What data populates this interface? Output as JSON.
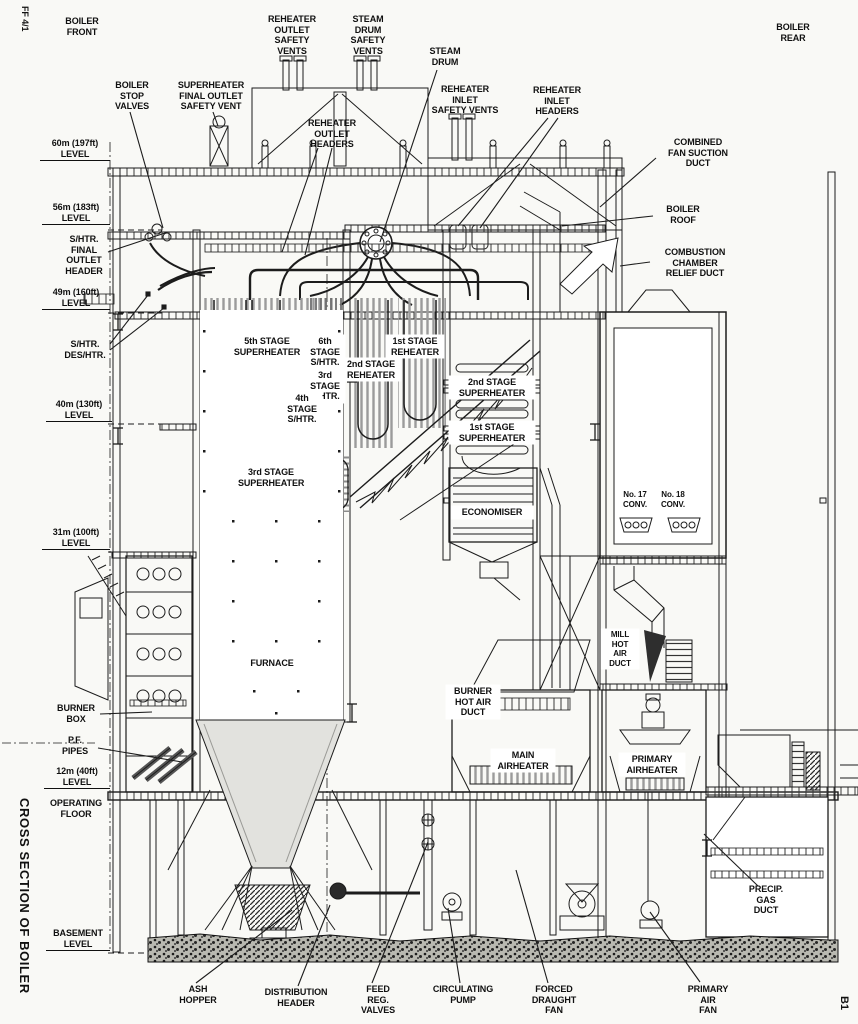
{
  "drawing": {
    "sheet_ref_top_left": "FF 4/1",
    "sheet_ref_bottom_right": "B1",
    "title": "CROSS SECTION OF BOILER"
  },
  "labels": {
    "boiler_front": "BOILER\nFRONT",
    "boiler_rear": "BOILER\nREAR",
    "reheater_outlet_safety_vents": "REHEATER\nOUTLET\nSAFETY\nVENTS",
    "steam_drum_safety_vents": "STEAM\nDRUM\nSAFETY\nVENTS",
    "steam_drum": "STEAM\nDRUM",
    "reheater_inlet_safety_vents": "REHEATER\nINLET\nSAFETY VENTS",
    "reheater_inlet_headers": "REHEATER\nINLET\nHEADERS",
    "boiler_stop_valves": "BOILER\nSTOP\nVALVES",
    "superheater_final_outlet_safety_vent": "SUPERHEATER\nFINAL OUTLET\nSAFETY VENT",
    "reheater_outlet_headers": "REHEATER\nOUTLET\nHEADERS",
    "combined_fan_suction_duct": "COMBINED\nFAN SUCTION\nDUCT",
    "boiler_roof": "BOILER\nROOF",
    "combustion_chamber_relief_duct": "COMBUSTION\nCHAMBER\nRELIEF DUCT",
    "level_60m": "60m (197ft)\nLEVEL",
    "level_56m": "56m (183ft)\nLEVEL",
    "shtr_final_outlet_header": "S/HTR.\nFINAL\nOUTLET\nHEADER",
    "level_49m": "49m (160ft)\nLEVEL",
    "shtr_deshtr": "S/HTR.\nDES/HTR.",
    "level_40m": "40m (130ft)\nLEVEL",
    "level_31m": "31m (100ft)\nLEVEL",
    "burner_box": "BURNER\nBOX",
    "pf_pipes": "P.F.\nPIPES",
    "level_12m": "12m (40ft)\nLEVEL",
    "operating_floor": "OPERATING\nFLOOR",
    "basement_level": "BASEMENT\nLEVEL",
    "stage_5_superheater": "5th STAGE\nSUPERHEATER",
    "stage_6_shtr": "6th\nSTAGE\nS/HTR.",
    "stage_3_rhtr": "3rd\nSTAGE\nR/HTR.",
    "stage_1_reheater": "1st STAGE\nREHEATER",
    "stage_2_reheater": "2nd STAGE\nREHEATER",
    "stage_4_shtr": "4th\nSTAGE\nS/HTR.",
    "stage_3_superheater": "3rd STAGE\nSUPERHEATER",
    "stage_2_superheater": "2nd STAGE\nSUPERHEATER",
    "stage_1_superheater": "1st STAGE\nSUPERHEATER",
    "economiser": "ECONOMISER",
    "conv_17": "No. 17\nCONV.",
    "conv_18": "No. 18\nCONV.",
    "furnace": "FURNACE",
    "mill_hot_air_duct": "MILL\nHOT\nAIR\nDUCT",
    "burner_hot_air_duct": "BURNER\nHOT AIR\nDUCT",
    "main_airheater": "MAIN\nAIRHEATER",
    "primary_airheater": "PRIMARY\nAIRHEATER",
    "precip_gas_duct": "PRECIP.\nGAS\nDUCT",
    "ash_hopper": "ASH\nHOPPER",
    "distribution_header": "DISTRIBUTION\nHEADER",
    "feed_reg_valves": "FEED\nREG.\nVALVES",
    "circulating_pump": "CIRCULATING\nPUMP",
    "forced_draught_fan": "FORCED\nDRAUGHT\nFAN",
    "primary_air_fan": "PRIMARY\nAIR\nFAN"
  },
  "colors": {
    "paper": "#f9f9f6",
    "ink": "#1c1c1c",
    "bank_gray": "#9b9b9b",
    "shade_gray": "#dededb"
  }
}
